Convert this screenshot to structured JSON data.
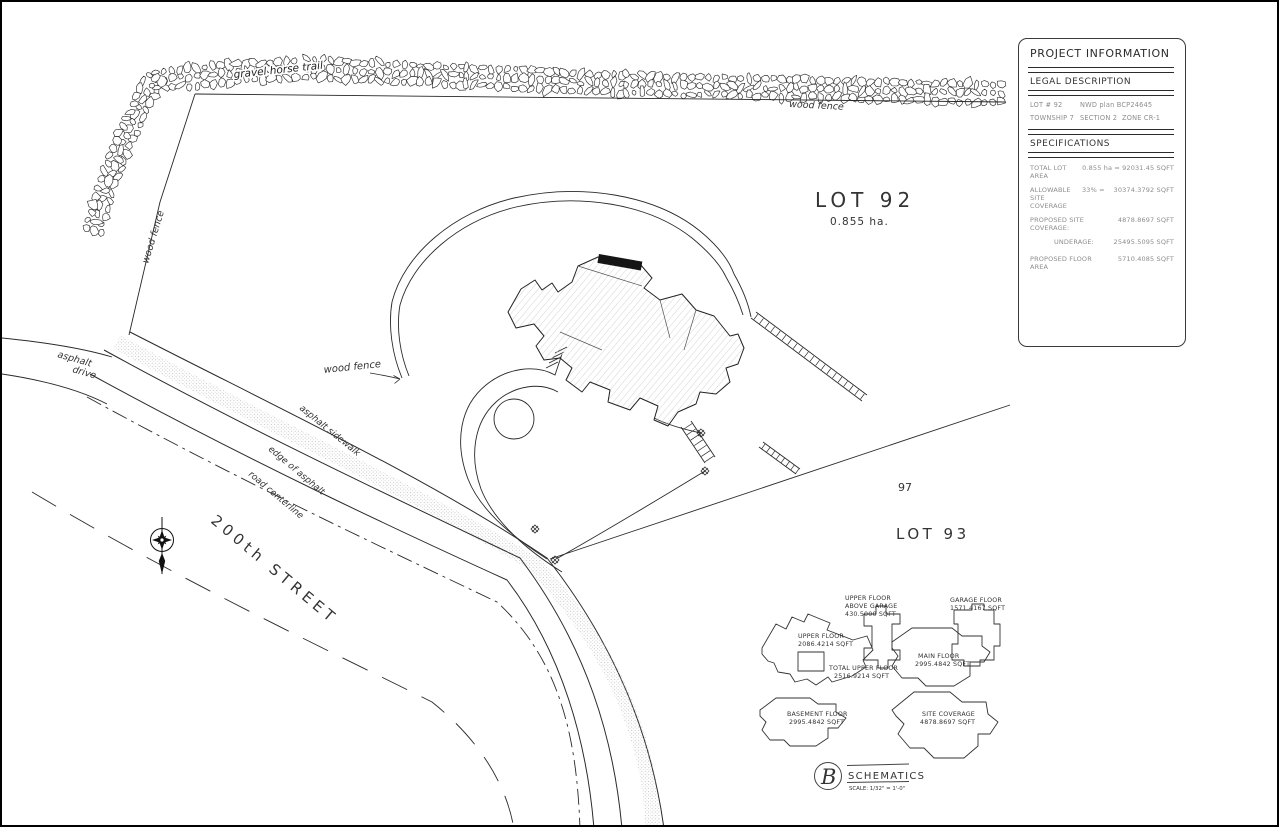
{
  "drawing": {
    "labels": {
      "gravel_horse_trail": "gravel horse trail",
      "wood_fence_top": "wood fence",
      "wood_fence_left": "wood fence",
      "wood_fence_mid": "wood fence",
      "asphalt_drive_line1": "asphalt",
      "asphalt_drive_line2": "drive",
      "asphalt_sidewalk": "asphalt sidewalk",
      "edge_of_asphalt": "edge of asphalt",
      "road_centerline": "road centerline",
      "street_name": "200th STREET",
      "lot92_title": "LOT 92",
      "lot92_area": "0.855 ha.",
      "lot93_title": "LOT 93",
      "lot_line_distance": "97"
    }
  },
  "info_panel": {
    "title": "PROJECT INFORMATION",
    "legal": {
      "heading": "LEGAL DESCRIPTION",
      "lot": "LOT # 92",
      "plan": "NWD plan   BCP24645",
      "township": "TOWNSHIP 7",
      "section": "SECTION 2",
      "zone": "ZONE   CR-1"
    },
    "specs": {
      "heading": "SPECIFICATIONS",
      "total_lot_area_label": "TOTAL LOT AREA",
      "total_lot_area_value": "0.855 ha = 92031.45 SQFT",
      "allowable_label": "ALLOWABLE SITE COVERAGE",
      "allowable_pct": "33%  =",
      "allowable_value": "30374.3792 SQFT",
      "proposed_site_label": "PROPOSED SITE COVERAGE:",
      "proposed_site_value": "4878.8697 SQFT",
      "underage_label": "UNDERAGE:",
      "underage_value": "25495.5095 SQFT",
      "proposed_floor_label": "PROPOSED FLOOR AREA",
      "proposed_floor_value": "5710.4085 SQFT"
    }
  },
  "plans": {
    "upper": {
      "l1": "UPPER FLOOR",
      "l2": "2086.4214 SQFT"
    },
    "above_garage": {
      "l1": "UPPER FLOOR",
      "l2": "ABOVE GARAGE",
      "l3": "430.5000 SQFT"
    },
    "total_upper": {
      "l1": "TOTAL UPPER FLOOR",
      "l2": "2516.9214 SQFT"
    },
    "garage": {
      "l1": "GARAGE FLOOR",
      "l2": "1571.4167 SQFT"
    },
    "main": {
      "l1": "MAIN FLOOR",
      "l2": "2995.4842 SQFT"
    },
    "basement": {
      "l1": "BASEMENT FLOOR",
      "l2": "2995.4842 SQFT"
    },
    "site_coverage": {
      "l1": "SITE COVERAGE",
      "l2": "4878.8697 SQFT"
    }
  },
  "logo": {
    "initial": "B",
    "name": "SCHEMATICS",
    "scale": "SCALE: 1/32\" = 1'-0\""
  },
  "colors": {
    "line": "#222222",
    "text_gray": "#8d8d8d",
    "bg": "#ffffff"
  }
}
